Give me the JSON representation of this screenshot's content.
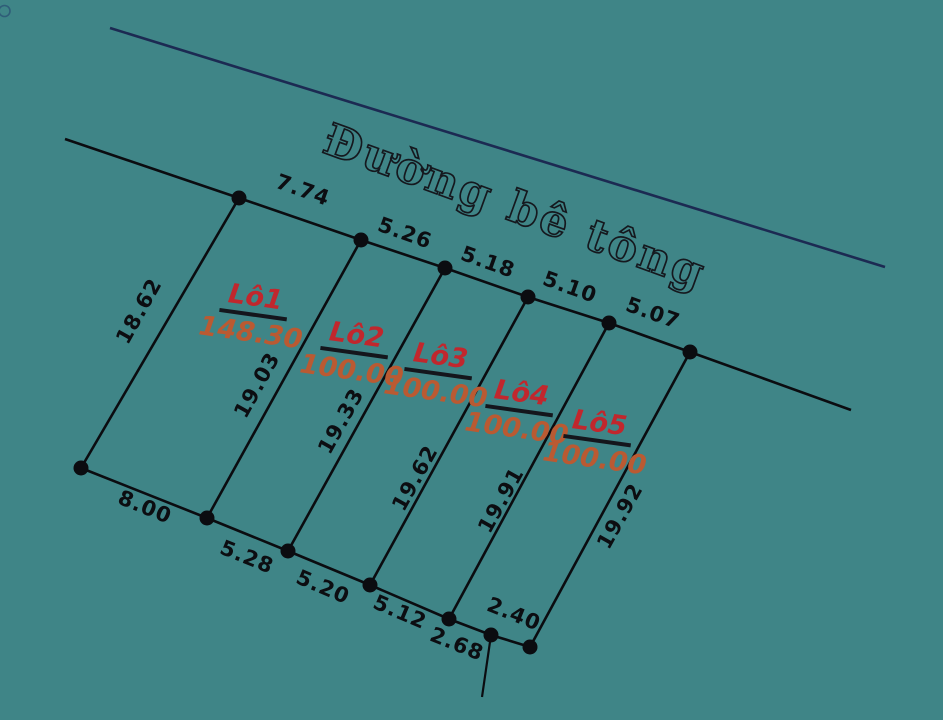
{
  "road": {
    "label": "Đường bê tông"
  },
  "lots": [
    {
      "name": "Lô1",
      "area": "148.30"
    },
    {
      "name": "Lô2",
      "area": "100.00"
    },
    {
      "name": "Lô3",
      "area": "100.00"
    },
    {
      "name": "Lô4",
      "area": "100.00"
    },
    {
      "name": "Lô5",
      "area": "100.00"
    }
  ],
  "dimensions": {
    "top": [
      "7.74",
      "5.26",
      "5.18",
      "5.10",
      "5.07"
    ],
    "bottom": [
      "8.00",
      "5.28",
      "5.20",
      "5.12",
      "2.68",
      "2.40"
    ],
    "sides": [
      "18.62",
      "19.03",
      "19.33",
      "19.62",
      "19.91",
      "19.92"
    ]
  },
  "colors": {
    "background": "#3F8587",
    "lot_name": "#C1272D",
    "lot_area": "#BA5A32",
    "boundary_line": "#0b0c10",
    "road_line": "#1C2A52"
  }
}
